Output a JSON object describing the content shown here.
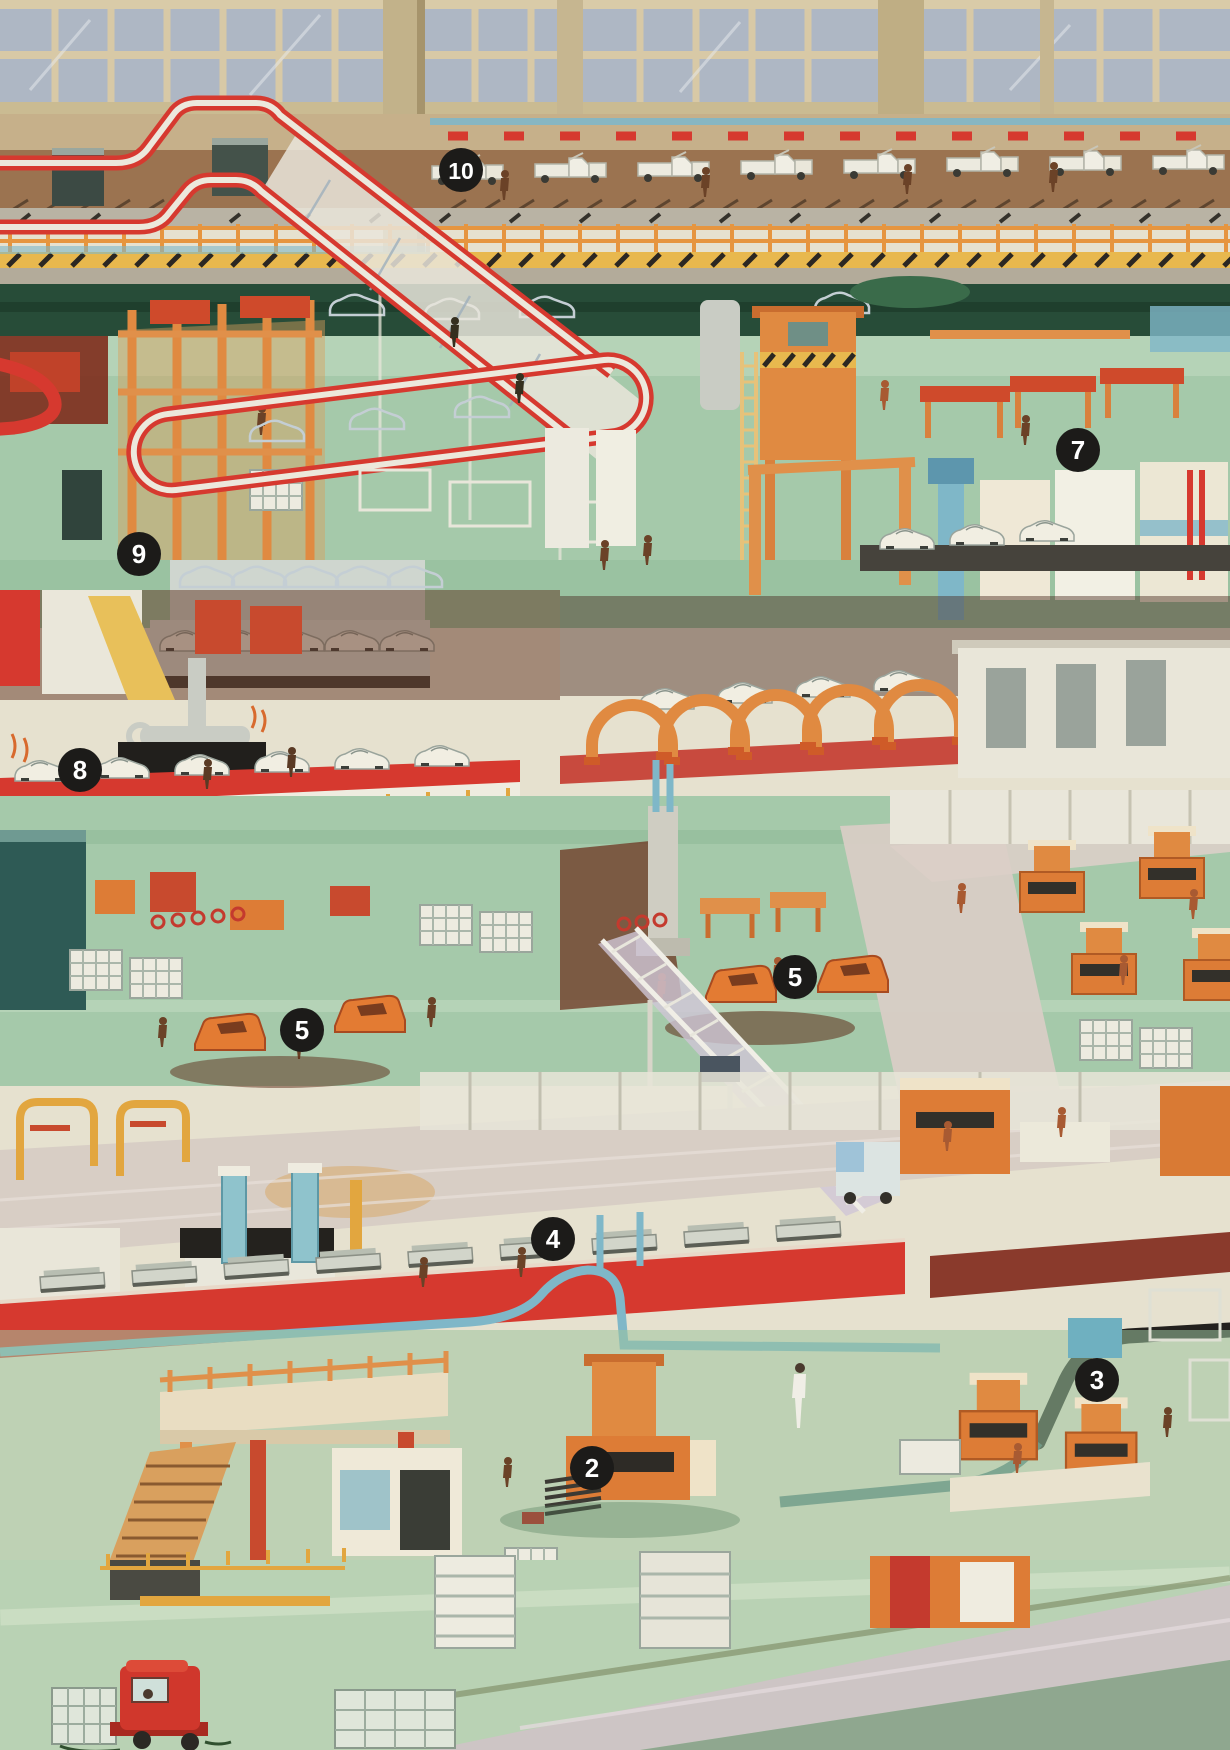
{
  "scene": {
    "kind": "cutaway-factory-illustration",
    "subject": "Car assembly plant with numbered production stages",
    "width": 1230,
    "height": 1750
  },
  "markers": [
    {
      "label": "10",
      "x": 461,
      "y": 170
    },
    {
      "label": "9",
      "x": 139,
      "y": 554
    },
    {
      "label": "8",
      "x": 80,
      "y": 770
    },
    {
      "label": "7",
      "x": 1078,
      "y": 450
    },
    {
      "label": "5",
      "x": 795,
      "y": 977
    },
    {
      "label": "5",
      "x": 302,
      "y": 1030
    },
    {
      "label": "4",
      "x": 553,
      "y": 1239
    },
    {
      "label": "3",
      "x": 1097,
      "y": 1380
    },
    {
      "label": "2",
      "x": 592,
      "y": 1468
    }
  ],
  "marker_style": {
    "radius": 22,
    "bg": "#1c1b19",
    "fg": "#ffffff",
    "font_size": 26,
    "font_size_wide": 23
  },
  "palette": {
    "red": "#d6392f",
    "red_deep": "#b02a24",
    "orange": "#e08a41",
    "orange_deep": "#cf5b28",
    "orange_machine": "#dd7c36",
    "green_floor": "#a5c9aa",
    "green_light": "#c6ddc4",
    "green_dark": "#274c38",
    "teal": "#7fb7c8",
    "cream": "#efece0",
    "wall_tan": "#b9a67d",
    "window_pane": "#aeb7c4",
    "window_frame": "#d8c9a6",
    "deck_brown": "#9b7350",
    "rail_orange": "#e6953f",
    "hazard_yellow": "#e8b84e",
    "maroon": "#5f3322",
    "aisle_pink": "#d8cec5",
    "worker_brown": "#6b4227",
    "worker_rust": "#a85a32",
    "pipe_black": "#23211e",
    "white": "#f2f0e6"
  }
}
